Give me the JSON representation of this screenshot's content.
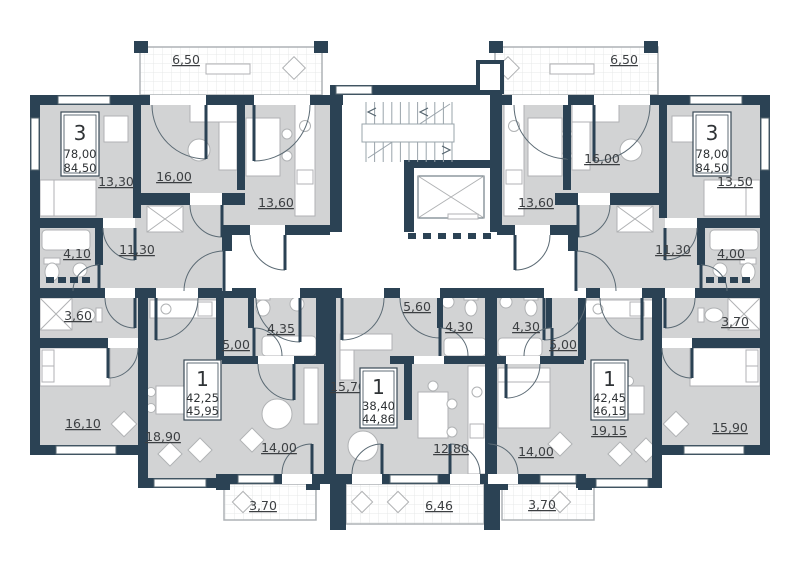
{
  "colors": {
    "wall": "#2b4254",
    "room_fill": "#d2d3d4",
    "background": "#ffffff",
    "furniture_line": "#b0b2b4",
    "label_text": "#3c3f42"
  },
  "apartments": {
    "apt3_left": {
      "rooms": "3",
      "area_living": "78,00",
      "area_total": "84,50"
    },
    "apt3_right": {
      "rooms": "3",
      "area_living": "78,00",
      "area_total": "84,50"
    },
    "apt1_left": {
      "rooms": "1",
      "area_living": "42,25",
      "area_total": "45,95"
    },
    "apt1_center": {
      "rooms": "1",
      "area_living": "38,40",
      "area_total": "44,86"
    },
    "apt1_right": {
      "rooms": "1",
      "area_living": "42,45",
      "area_total": "46,15"
    }
  },
  "room_labels": {
    "apt3_left": {
      "balcony": "6,50",
      "bedroom1": "13,30",
      "living": "16,00",
      "kitchen": "13,60",
      "bath": "4,10",
      "hall": "11,30",
      "wc": "3,60",
      "bedroom2": "16,10"
    },
    "apt3_right": {
      "balcony": "6,50",
      "bedroom1": "13,50",
      "living": "16,00",
      "kitchen": "13,60",
      "bath": "4,00",
      "hall": "11,30",
      "wc": "3,70",
      "bedroom2": "15,90"
    },
    "apt1_left": {
      "kitchen_living": "18,90",
      "hall": "5,00",
      "bath": "4,35",
      "bedroom": "14,00",
      "balcony": "3,70"
    },
    "apt1_center": {
      "living": "15,70",
      "hall": "5,60",
      "bath": "4,30",
      "kitchen": "12,80",
      "balcony": "6,46"
    },
    "apt1_right": {
      "kitchen_living": "19,15",
      "hall": "5,00",
      "bath": "4,30",
      "bedroom": "14,00",
      "balcony": "3,70"
    }
  }
}
